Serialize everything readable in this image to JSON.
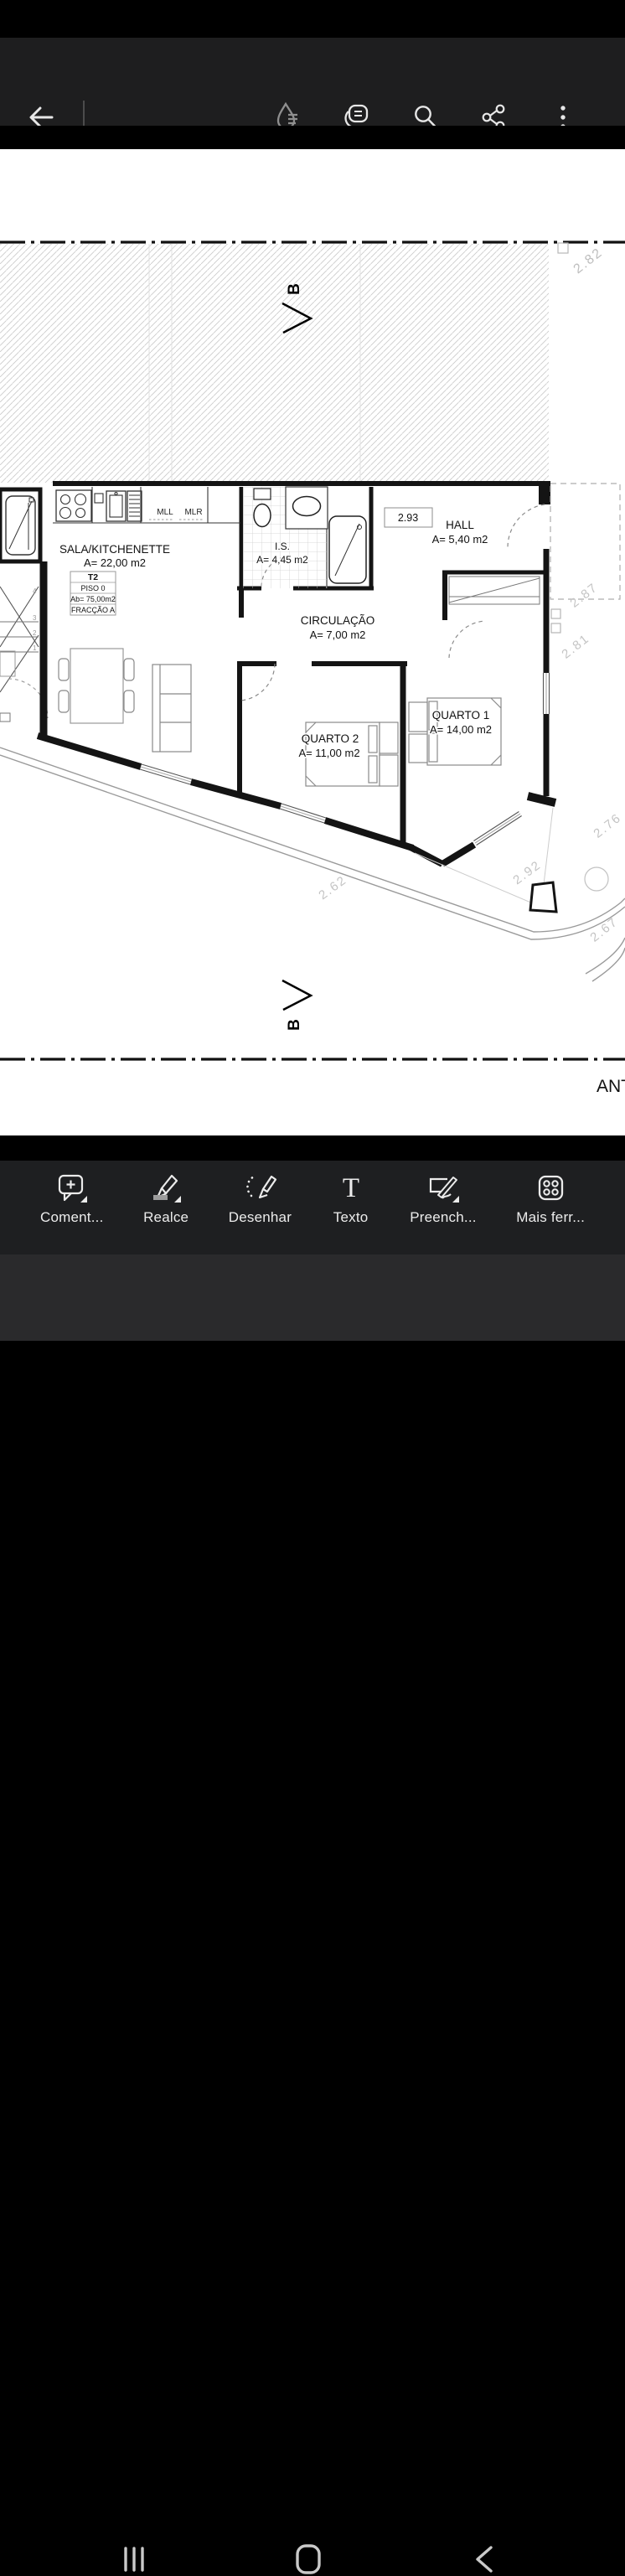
{
  "top_toolbar": {
    "icons": [
      "back-icon",
      "liquid-mode-icon",
      "comments-icon",
      "search-icon",
      "share-icon",
      "overflow-menu-icon"
    ]
  },
  "floor_plan": {
    "section_top": "B",
    "section_bottom": "B",
    "dim_box": "2.93",
    "dims": {
      "top_right": "2.82",
      "right_upper": "2.87",
      "right_lower": "2.81",
      "bottom_left": "2.62",
      "bottom_mid": "2.92",
      "bottom_right_upper": "2.76",
      "bottom_right_lower": "2.67"
    },
    "kitchen": {
      "mll": "MLL",
      "mlr": "MLR"
    },
    "unit_box": [
      "T2",
      "PISO 0",
      "Ab= 75,00m2",
      "FRACÇÃO A"
    ],
    "rooms": {
      "sala": {
        "name": "SALA/KITCHENETTE",
        "area": "A= 22,00 m2"
      },
      "is": {
        "name": "I.S.",
        "area": "A= 4,45 m2"
      },
      "hall": {
        "name": "HALL",
        "area": "A= 5,40 m2"
      },
      "circ": {
        "name": "CIRCULAÇÃO",
        "area": "A= 7,00 m2"
      },
      "q1": {
        "name": "QUARTO 1",
        "area": "A= 14,00 m2"
      },
      "q2": {
        "name": "QUARTO 2",
        "area": "A= 11,00 m2"
      }
    },
    "stairs": [
      "4",
      "3",
      "2",
      "1"
    ],
    "partial_text": "ANTA"
  },
  "fab": {
    "gradient_start": "#c92d75",
    "gradient_end": "#6d39de",
    "icon": "ai-comment-sparkle-icon"
  },
  "bottom_toolbar": {
    "tools": [
      {
        "label": "Coment..."
      },
      {
        "label": "Realce"
      },
      {
        "label": "Desenhar"
      },
      {
        "label": "Texto",
        "icon_glyph": "T"
      },
      {
        "label": "Preench..."
      },
      {
        "label": "Mais ferr..."
      }
    ]
  },
  "colors": {
    "toolbar_bg": "#1e1e1f",
    "nav_bg": "#2a2a2c",
    "icon": "#e7e7e7"
  }
}
